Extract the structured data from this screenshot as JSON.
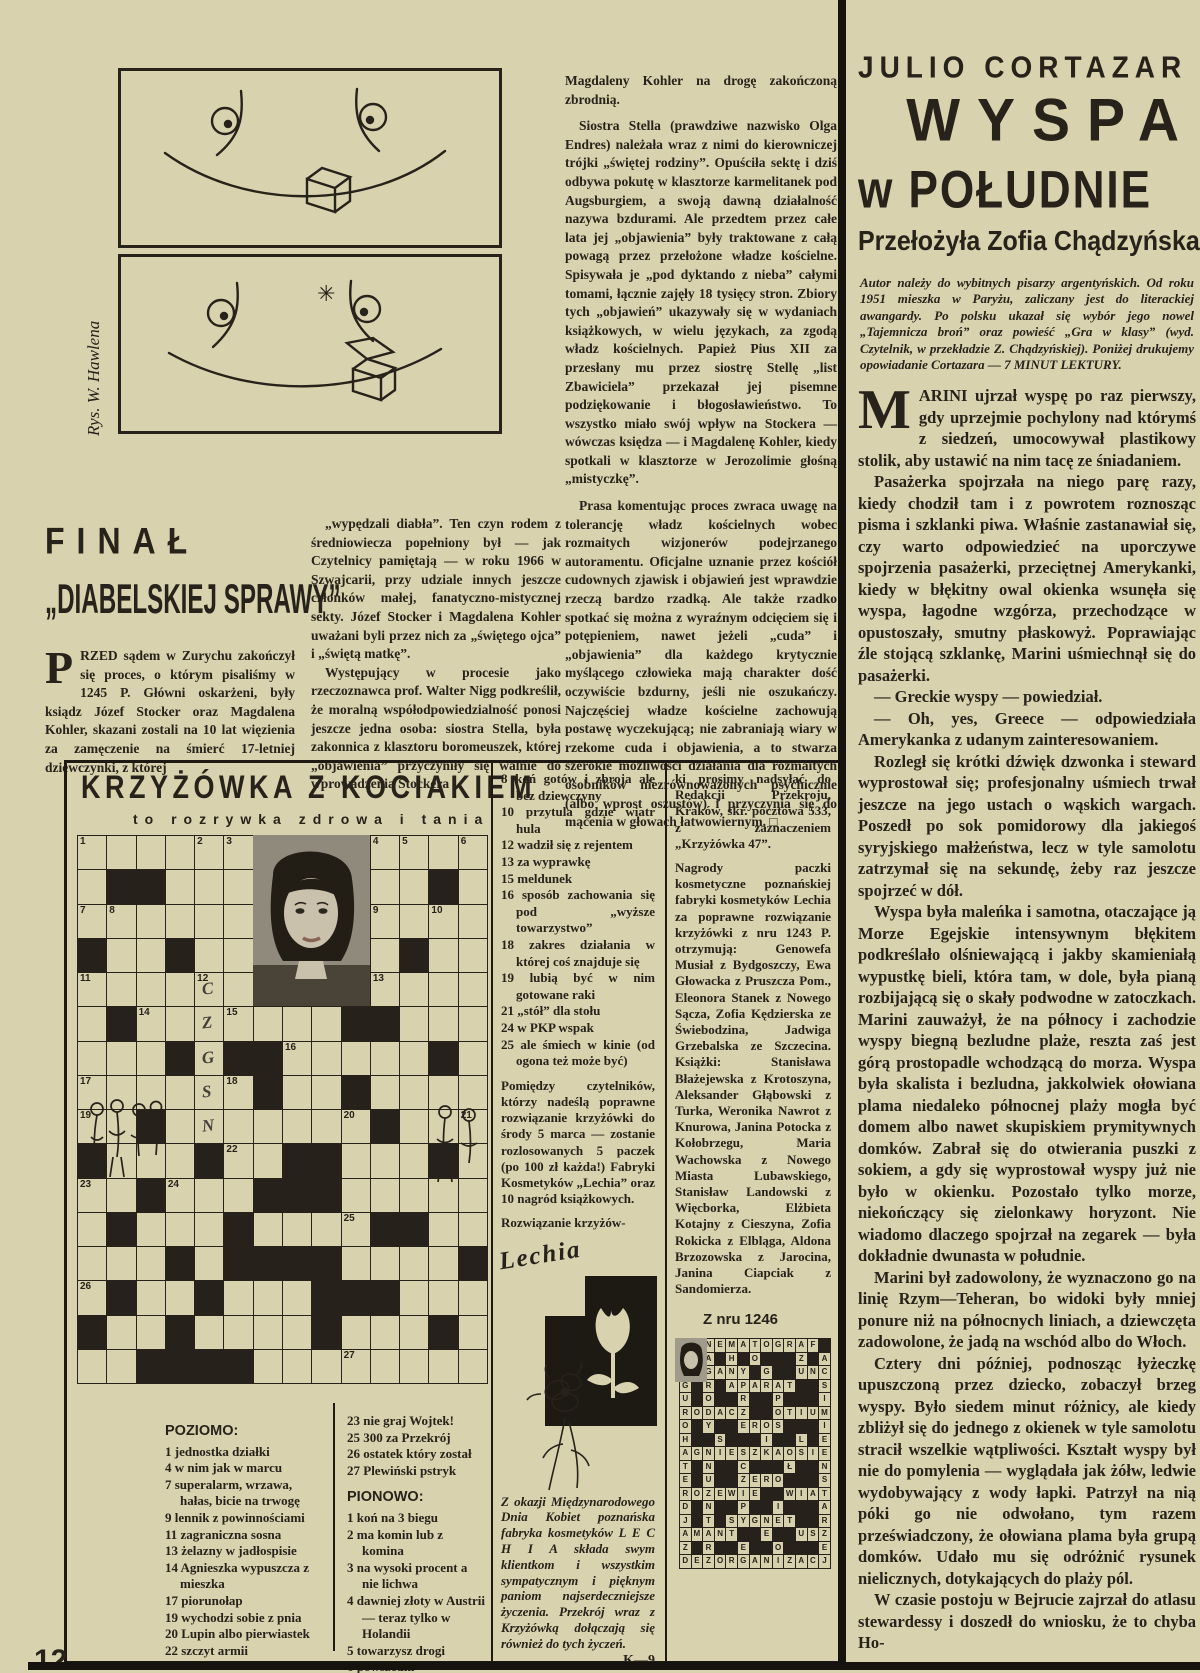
{
  "page": {
    "number": "12"
  },
  "cartoon": {
    "credit": "Rys. W. Hawlena"
  },
  "left_article": {
    "title_line1": "FINAŁ",
    "title_line2": "„DIABELSKIEJ SPRAWY”",
    "dropcap": "P",
    "col1_text": "RZED sądem w Zurychu zakończył się proces, o którym pisaliśmy w 1245 P. Główni oskarżeni, były ksiądz Józef Stocker oraz Magdalena Kohler, skazani zostali na 10 lat więzienia za zamęczenie na śmierć 17-letniej dziewczynki, z której",
    "col2_paras": [
      "„wypędzali diabła”. Ten czyn rodem z średniowiecza popełniony był — jak Czytelnicy pamiętają — w roku 1966 w Szwajcarii, przy udziale innych jeszcze członków małej, fanatyczno-mistycznej sekty. Józef Stocker i Magdalena Kohler uważani byli przez nich za „świętego ojca” i „świętą matkę”.",
      "Występujący w procesie jako rzeczoznawca prof. Walter Nigg podkreślił, że moralną współodpowiedzialność ponosi jeszcze jedna osoba: siostra Stella, była zakonnica z klasztoru boromeuszek, której „objawienia” przyczyniły się walnie do wprowadzenia Stockera i"
    ]
  },
  "mid_article": {
    "lead": "Magdaleny Kohler na drogę zakończoną zbrodnią.",
    "paras": [
      "Siostra Stella (prawdziwe nazwisko Olga Endres) należała wraz z nimi do kierowniczej trójki „świętej rodziny”. Opuściła sektę i dziś odbywa pokutę w klasztorze karmelitanek pod Augsburgiem, a swoją dawną działalność nazywa bzdurami. Ale przedtem przez całe lata jej „objawienia” były traktowane z całą powagą przez przełożone władze kościelne. Spisywała je „pod dyktando z nieba” całymi tomami, łącznie zajęły 18 tysięcy stron. Zbiory tych „objawień” ukazywały się w wydaniach książkowych, w wielu językach, za zgodą władz kościelnych. Papież Pius XII za przesłany mu przez siostrę Stellę „list Zbawiciela” przekazał jej pisemne podziękowanie i błogosławieństwo. To wszystko miało swój wpływ na Stockera — wówczas księdza — i Magdalenę Kohler, kiedy spotkali w klasztorze w Jerozolimie głośną „mistyczkę”.",
      "Prasa komentując proces zwraca uwagę na tolerancję władz kościelnych wobec rozmaitych wizjonerów podejrzanego autoramentu. Oficjalne uznanie przez kościół cudownych zjawisk i objawień jest wprawdzie rzeczą bardzo rzadką. Ale także rzadko spotkać się można z wyraźnym odcięciem się i potępieniem, nawet jeżeli „cuda” i „objawienia” dla każdego krytycznie myślącego człowieka mają charakter dość oczywiście bzdurny, jeśli nie oszukańczy. Najczęściej władze kościelne zachowują postawę wyczekującą; nie zabraniają wiary w rzekome cuda i objawienia, a to stwarza szerokie możliwości działania dla rozmaitych osobników niezrównoważonych psychicznie (albo wprost oszustów) i przyczynia się do mącenia w głowach łatwowiernym. □"
    ]
  },
  "crossword": {
    "title": "KRZYŻÓWKA Z KOCIAKIEM",
    "subtitle": "to rozrywka zdrowa i tania",
    "poziomo_label": "POZIOMO:",
    "poziomo": [
      "1 jednostka działki",
      "4 w nim jak w marcu",
      "7 superalarm, wrzawa, hałas, bicie na trwogę",
      "9 lennik z powinnościami",
      "11 zagraniczna sosna",
      "13 żelazny w jadłospisie",
      "14 Agnieszka wypuszcza z mieszka",
      "17 piorunołap",
      "19 wychodzi sobie z pnia",
      "20 Lupin albo pierwiastek",
      "22 szczyt armii"
    ],
    "colb_clues": [
      "23 nie graj Wojtek!",
      "25 300 za Przekrój",
      "26 ostatek który został",
      "27 Plewiński pstryk"
    ],
    "pionowo_label": "PIONOWO:",
    "pionowo": [
      "1 koń na 3 biegu",
      "2 ma komin lub z komina",
      "3 na wysoki procent a nie lichwa",
      "4 dawniej złoty w Austrii — teraz tylko w Holandii",
      "5 towarzysz drogi",
      "6 powszedni"
    ],
    "mid_clues": [
      "8 koń gotów i zbroja ale bez dziewczyny",
      "10 przytula gdzie wiatr hula",
      "12 wadził się z rejentem",
      "13 za wyprawkę",
      "15 meldunek",
      "16 sposób zachowania się pod „wyższe towarzystwo”",
      "18 zakres działania w której coś znajduje się",
      "19 lubią być w nim gotowane raki",
      "21 „stół” dla stołu",
      "24 w PKP wspak",
      "25 ale śmiech w kinie (od ogona też może być)"
    ],
    "prize_para": "Pomiędzy czytelników, którzy nadeślą poprawne rozwiązanie krzyżówki do środy 5 marca — zostanie rozlosowanych 5 paczek (po 100 zł każda!) Fabryki Kosmetyków „Lechia” oraz 10 nagród książkowych.",
    "solution_lead": "Rozwiązanie krzyżów-",
    "mailing_para": "ki prosimy nadsyłać do Redakcji Przekroju, Kraków, skr. pocztowa 533, z zaznaczeniem „Krzyżówka 47”.",
    "winners_para": "Nagrody paczki kosmetyczne poznańskiej fabryki kosmetyków Lechia za poprawne rozwiązanie krzyżówki z nru 1243 P. otrzymują: Genowefa Musiał z Bydgoszczy, Ewa Głowacka z Pruszcza Pom., Eleonora Stanek z Nowego Sącza, Zofia Kędzierska ze Świebodzina, Jadwiga Grzebalska ze Szczecina. Książki: Stanisława Błażejewska z Krotoszyna, Aleksander Głąbowski z Turka, Weronika Nawrot z Knurowa, Janina Potocka z Kołobrzegu, Maria Wachowska z Nowego Miasta Lubawskiego, Stanisław Landowski z Więcborka, Elżbieta Kotajny z Cieszyna, Zofia Rokicka z Elbląga, Aldona Brzozowska z Jarocina, Janina Ciapciak z Sandomierza.",
    "from_issue": "Z nru 1246",
    "lechia_script": "Lechia",
    "lechia_text": "Z okazji Międzynarodowego Dnia Kobiet poznańska fabryka kosmetyków L E C H I A składa swym klientkom i wszystkim sympatycznym i pięknym paniom najserdeczniejsze życzenia. Przekrój wraz z Krzyżówką dołączają się również do tych życzeń.",
    "lechia_sign": "K—9",
    "grid": {
      "cols": 14,
      "rows": 16,
      "pattern": [
        "......PPPP....",
        ".##...PPPP..#.",
        "......PPPP....",
        "#..#..PPPP.#..",
        "......PPPP....",
        ".#.......##...",
        "...#.##.....#.",
        "......#..#....",
        "..#.......#...",
        "#...#..##...#.",
        "..#...###.....",
        ".#...#....##..",
        "...#.####....#",
        ".#..#...###...",
        "#..#....#...#.",
        "..####........"
      ],
      "numbers": {
        "0,0": "1",
        "0,4": "2",
        "0,5": "3",
        "0,10": "4",
        "0,11": "5",
        "0,13": "6",
        "2,0": "7",
        "2,1": "8",
        "2,10": "9",
        "2,12": "10",
        "4,0": "11",
        "4,4": "12",
        "4,10": "13",
        "5,2": "14",
        "5,5": "15",
        "6,7": "16",
        "7,0": "17",
        "7,5": "18",
        "8,0": "19",
        "8,9": "20",
        "8,13": "21",
        "9,5": "22",
        "10,0": "23",
        "10,3": "24",
        "11,9": "25",
        "13,0": "26",
        "15,9": "27"
      },
      "pencil": {
        "4,4": "C",
        "5,4": "Z",
        "6,4": "G",
        "7,4": "S",
        "8,4": "N"
      }
    },
    "solution_rows": [
      "KINEMATOGRAF ",
      "A A H O   Z A",
      "WAGANY G  UNC",
      "G R APARAT  S",
      "U O  R  P   I",
      "RODACZ  OTIUM",
      "O Y  EROS   I",
      "H  S   I  L E",
      "AGNIESZKAOSIE",
      "T N  C   Ł  N",
      "E U  ZERO   S",
      "ROZEWIE  WIAT",
      "D N  P  I   A",
      "J T SYGNET  R",
      "AMANT  E  USZ",
      "Z R  E  O   E",
      "DEZORGANIZACJ"
    ]
  },
  "right_article": {
    "author": "JULIO CORTAZAR",
    "title1": "WYSPA",
    "title2": "w POŁUDNIE",
    "translator": "Przełożyła Zofia Chądzyńska",
    "intro": "Autor należy do wybitnych pisarzy argentyńskich. Od roku 1951 mieszka w Paryżu, zaliczany jest do literackiej awangardy. Po polsku ukazał się wybór jego nowel „Tajemnicza broń” oraz powieść „Gra w klasy” (wyd. Czytelnik, w przekładzie Z. Chądzyńskiej). Poniżej drukujemy opowiadanie Cortazara — 7 MINUT LEKTURY.",
    "dropcap": "M",
    "p1": "ARINI ujrzał wyspę po raz pierwszy, gdy uprzejmie pochylony nad którymś z siedzeń, umocowywał plastikowy stolik, aby ustawić na nim tacę ze śniadaniem.",
    "paras": [
      "Pasażerka spojrzała na niego parę razy, kiedy chodził tam i z powrotem roznosząc pisma i szklanki piwa. Właśnie zastanawiał się, czy warto odpowiedzieć na uporczywe spojrzenia pasażerki, przeciętnej Amerykanki, kiedy w błękitny owal okienka wsunęła się wyspa, łagodne wzgórza, przechodzące w opustoszały, smutny płaskowyż. Poprawiając źle stojącą szklankę, Marini uśmiechnął się do pasażerki.",
      "— Greckie wyspy — powiedział.",
      "— Oh, yes, Greece — odpowiedziała Amerykanka z udanym zainteresowaniem.",
      "Rozległ się krótki dźwięk dzwonka i steward wyprostował się; profesjonalny uśmiech trwał jeszcze na jego ustach o wąskich wargach. Poszedł po sok pomidorowy dla jakiegoś syryjskiego małżeństwa, lecz w tyle samolotu zatrzymał się na sekundę, żeby raz jeszcze spojrzeć w dół.",
      "Wyspa była maleńka i samotna, otaczające ją Morze Egejskie intensywnym błękitem podkreślało olśniewającą i jakby skamieniałą wypustkę bieli, która tam, w dole, była pianą rozbijającą się o skały podwodne w zatoczkach. Marini zauważył, że na północy i zachodzie wyspy biegną bezludne plaże, reszta zaś jest górą prostopadle wchodzącą do morza. Wyspa była skalista i bezludna, jakkolwiek ołowiana plama niedaleko północnej plaży mogła być domem albo nawet skupiskiem prymitywnych domków. Zabrał się do otwierania puszki z sokiem, a gdy się wyprostował wyspy już nie było w okienku. Pozostało tylko morze, niekończący się zielonkawy horyzont. Nie wiadomo dlaczego spojrzał na zegarek — była dokładnie dwunasta w południe.",
      "Marini był zadowolony, że wyznaczono go na linię Rzym—Teheran, bo widoki były mniej ponure niż na północnych liniach, a dziewczęta zadowolone, że jadą na wschód albo do Włoch.",
      "Cztery dni później, podnosząc łyżeczkę upuszczoną przez dziecko, zobaczył brzeg wyspy. Było siedem minut różnicy, ale kiedy zbliżył się do jednego z okienek w tyle samolotu stracił wszelkie wątpliwości. Kształt wyspy był nie do pomylenia — wyglądała jak żółw, ledwie wydobywający z wody łapki. Patrzył na nią póki go nie odwołano, tym razem przeświadczony, że ołowiana plama była grupą domków. Udało mu się odróżnić rysunek nielicznych, dotykających do plaży pól.",
      "W czasie postoju w Bejrucie zajrzał do atlasu stewardessy i doszedł do wniosku, że to chyba Ho-"
    ]
  }
}
